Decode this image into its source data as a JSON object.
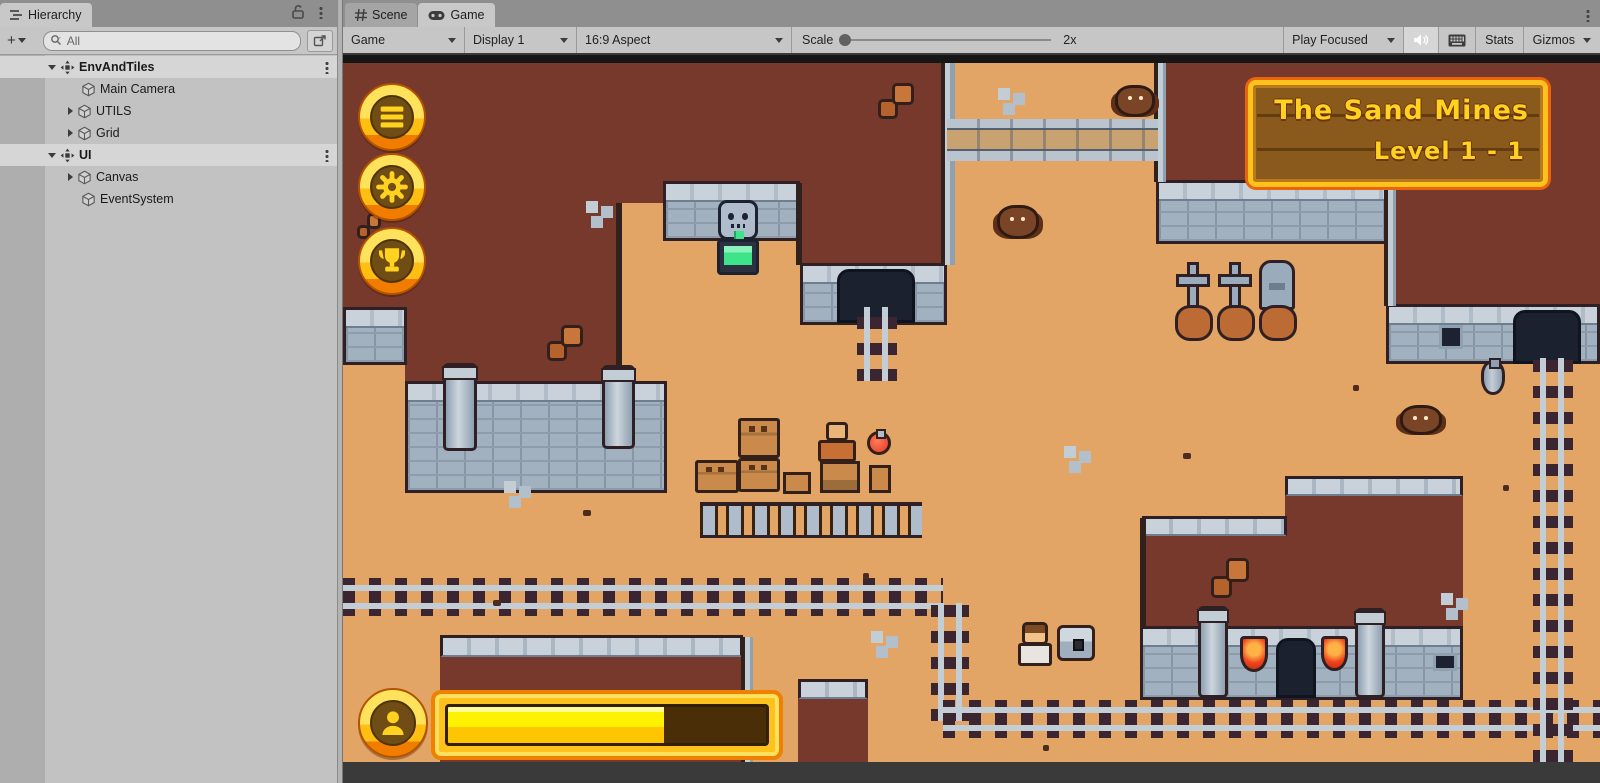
{
  "hierarchy": {
    "tab_label": "Hierarchy",
    "add_label": "+",
    "search_placeholder": "All",
    "rows": [
      {
        "label": "EnvAndTiles",
        "icon": "group",
        "depth": 0,
        "caret": "down",
        "bold": true,
        "selected": true,
        "kebab": true
      },
      {
        "label": "Main Camera",
        "icon": "cube",
        "depth": 1,
        "caret": "none"
      },
      {
        "label": "UTILS",
        "icon": "cube",
        "depth": 1,
        "caret": "right"
      },
      {
        "label": "Grid",
        "icon": "cube",
        "depth": 1,
        "caret": "right"
      },
      {
        "label": "UI",
        "icon": "group",
        "depth": 0,
        "caret": "down",
        "bold": true,
        "selected": true,
        "kebab": true
      },
      {
        "label": "Canvas",
        "icon": "cube",
        "depth": 1,
        "caret": "right"
      },
      {
        "label": "EventSystem",
        "icon": "cube",
        "depth": 1,
        "caret": "none"
      }
    ]
  },
  "gameview": {
    "tabs": [
      {
        "label": "Scene",
        "icon": "scene",
        "active": false
      },
      {
        "label": "Game",
        "icon": "game",
        "active": true
      }
    ],
    "toolbar": {
      "display_mode": "Game",
      "display": "Display 1",
      "aspect": "16:9 Aspect",
      "scale_label": "Scale",
      "scale_value": "2x",
      "play_mode": "Play Focused",
      "stats_label": "Stats",
      "gizmos_label": "Gizmos"
    }
  },
  "game": {
    "banner": {
      "line1": "The Sand Mines",
      "line2": "Level 1 - 1"
    },
    "hud": {
      "progress_percent": 68,
      "buttons": [
        {
          "icon": "menu",
          "name": "hud-menu-button"
        },
        {
          "icon": "gear",
          "name": "hud-settings-button"
        },
        {
          "icon": "trophy",
          "name": "hud-trophy-button"
        }
      ],
      "profile_icon": "person"
    },
    "palette": {
      "sand": "#e2a566",
      "earth": "#76392b",
      "stone": "#a2b1bf",
      "gold": "#ffc21c",
      "orange": "#f08000",
      "rail_tie": "#3b2531",
      "rail": "#c3cdd6",
      "water_green": "#3ee48a",
      "banner_wood": "#8a5a1d"
    },
    "terrain": [
      {
        "type": "brown",
        "name": "plateau-top-left-a",
        "x": 0,
        "y": 0,
        "w": 324,
        "h": 148
      },
      {
        "type": "brown",
        "name": "plateau-top-left-b",
        "x": 62,
        "y": 148,
        "w": 215,
        "h": 180
      },
      {
        "type": "brown",
        "name": "plateau-top-left-c",
        "x": 0,
        "y": 148,
        "w": 62,
        "h": 106
      },
      {
        "type": "wall",
        "name": "wall-top-left",
        "x": 0,
        "y": 252,
        "w": 64,
        "h": 58
      },
      {
        "type": "wall",
        "name": "wall-left-pillared",
        "x": 62,
        "y": 326,
        "w": 262,
        "h": 112
      },
      {
        "type": "brown",
        "name": "plateau-top-center",
        "x": 324,
        "y": 0,
        "w": 280,
        "h": 128
      },
      {
        "type": "wall",
        "name": "wall-fountain",
        "x": 320,
        "y": 126,
        "w": 140,
        "h": 60
      },
      {
        "type": "brown",
        "name": "plateau-center-right",
        "x": 457,
        "y": 126,
        "w": 147,
        "h": 84
      },
      {
        "type": "wall",
        "name": "wall-center-mine",
        "x": 457,
        "y": 208,
        "w": 147,
        "h": 62
      },
      {
        "type": "arch",
        "name": "mine-entrance-center",
        "x": 494,
        "y": 214,
        "w": 78,
        "h": 54
      },
      {
        "type": "brown",
        "name": "plateau-top-right",
        "x": 813,
        "y": 0,
        "w": 444,
        "h": 127
      },
      {
        "type": "wall",
        "name": "wall-top-right",
        "x": 813,
        "y": 125,
        "w": 234,
        "h": 64
      },
      {
        "type": "brown",
        "name": "plateau-right-step",
        "x": 1043,
        "y": 125,
        "w": 214,
        "h": 126
      },
      {
        "type": "wall",
        "name": "wall-right-mine",
        "x": 1043,
        "y": 249,
        "w": 214,
        "h": 60
      },
      {
        "type": "arch",
        "name": "mine-entrance-right",
        "x": 1170,
        "y": 255,
        "w": 68,
        "h": 54
      },
      {
        "type": "beam",
        "name": "edge-top-center-right",
        "x": 598,
        "y": 0,
        "w": 14,
        "h": 210
      },
      {
        "type": "beam",
        "name": "edge-top-right-left",
        "x": 811,
        "y": 0,
        "w": 12,
        "h": 127
      },
      {
        "type": "beam",
        "name": "edge-right-step",
        "x": 1041,
        "y": 127,
        "w": 12,
        "h": 124
      },
      {
        "type": "edge",
        "name": "edge-pocket-left",
        "x": 273,
        "y": 148,
        "w": 6,
        "h": 180
      },
      {
        "type": "edge",
        "name": "edge-pocket-right",
        "x": 453,
        "y": 128,
        "w": 6,
        "h": 82
      },
      {
        "type": "brown",
        "name": "temple-upper",
        "x": 942,
        "y": 423,
        "w": 178,
        "h": 46
      },
      {
        "type": "cap",
        "name": "temple-upper-cap",
        "x": 942,
        "y": 421,
        "w": 178,
        "h": 20
      },
      {
        "type": "brown",
        "name": "temple-body",
        "x": 799,
        "y": 463,
        "w": 321,
        "h": 112
      },
      {
        "type": "cap",
        "name": "temple-body-cap",
        "x": 799,
        "y": 461,
        "w": 145,
        "h": 20
      },
      {
        "type": "edge",
        "name": "temple-left-edge",
        "x": 797,
        "y": 463,
        "w": 6,
        "h": 110
      },
      {
        "type": "wall",
        "name": "temple-front-wall",
        "x": 797,
        "y": 571,
        "w": 323,
        "h": 74
      },
      {
        "type": "brown",
        "name": "plateau-bottom-left",
        "x": 97,
        "y": 582,
        "w": 303,
        "h": 125
      },
      {
        "type": "cap",
        "name": "plateau-bottom-left-cap",
        "x": 97,
        "y": 580,
        "w": 303,
        "h": 22
      },
      {
        "type": "beam",
        "name": "plateau-bottom-left-beam",
        "x": 398,
        "y": 582,
        "w": 12,
        "h": 125
      },
      {
        "type": "brown",
        "name": "plateau-bottom-small",
        "x": 455,
        "y": 626,
        "w": 70,
        "h": 81
      },
      {
        "type": "cap",
        "name": "plateau-bottom-small-cap",
        "x": 455,
        "y": 624,
        "w": 70,
        "h": 20
      },
      {
        "type": "bridge",
        "name": "rail-bridge-top",
        "x": 604,
        "y": 64,
        "w": 211,
        "h": 42
      },
      {
        "type": "railh",
        "name": "rail-mid",
        "x": 0,
        "y": 523,
        "w": 600,
        "h": 38
      },
      {
        "type": "railv",
        "name": "rail-curve-down",
        "x": 588,
        "y": 548,
        "w": 38,
        "h": 118
      },
      {
        "type": "railh",
        "name": "rail-bottom",
        "x": 600,
        "y": 645,
        "w": 657,
        "h": 38
      },
      {
        "type": "railv",
        "name": "rail-right",
        "x": 1190,
        "y": 303,
        "w": 40,
        "h": 404
      },
      {
        "type": "railv",
        "name": "rail-center-short",
        "x": 514,
        "y": 252,
        "w": 40,
        "h": 74
      },
      {
        "type": "bar",
        "name": "letterbox-top",
        "x": 0,
        "y": 0,
        "w": 1257,
        "h": 8
      }
    ],
    "sprites": [
      {
        "type": "skull",
        "name": "fountain-skull",
        "x": 375,
        "y": 145,
        "w": 40,
        "h": 40
      },
      {
        "type": "stream",
        "name": "fountain-stream",
        "x": 391,
        "y": 176,
        "w": 10,
        "h": 14
      },
      {
        "type": "basin",
        "name": "fountain-basin",
        "x": 374,
        "y": 184,
        "w": 42,
        "h": 36
      },
      {
        "type": "pillar",
        "name": "wall-pillar-a",
        "x": 100,
        "y": 308,
        "w": 34,
        "h": 88
      },
      {
        "type": "pillar",
        "name": "wall-pillar-b",
        "x": 259,
        "y": 310,
        "w": 33,
        "h": 84
      },
      {
        "type": "pillar",
        "name": "temple-pillar-a",
        "x": 855,
        "y": 551,
        "w": 30,
        "h": 92
      },
      {
        "type": "pillar",
        "name": "temple-pillar-b",
        "x": 1012,
        "y": 553,
        "w": 30,
        "h": 90
      },
      {
        "type": "flag",
        "name": "temple-banner-a",
        "x": 897,
        "y": 581,
        "w": 28,
        "h": 36
      },
      {
        "type": "flag",
        "name": "temple-banner-b",
        "x": 978,
        "y": 581,
        "w": 27,
        "h": 35
      },
      {
        "type": "arch",
        "name": "temple-doorway",
        "x": 933,
        "y": 583,
        "w": 40,
        "h": 60
      },
      {
        "type": "window",
        "name": "temple-vent",
        "x": 1090,
        "y": 598,
        "w": 24,
        "h": 18
      },
      {
        "type": "window",
        "name": "wall-window",
        "x": 1096,
        "y": 270,
        "w": 24,
        "h": 24
      },
      {
        "type": "cross",
        "name": "grave-cross-a",
        "x": 833,
        "y": 207,
        "w": 34,
        "h": 48
      },
      {
        "type": "cross",
        "name": "grave-cross-b",
        "x": 875,
        "y": 207,
        "w": 34,
        "h": 48
      },
      {
        "type": "tomb",
        "name": "grave-stone",
        "x": 916,
        "y": 205,
        "w": 36,
        "h": 50
      },
      {
        "type": "mound",
        "name": "grave-mound-a",
        "x": 832,
        "y": 250,
        "w": 38,
        "h": 36
      },
      {
        "type": "mound",
        "name": "grave-mound-b",
        "x": 874,
        "y": 250,
        "w": 38,
        "h": 36
      },
      {
        "type": "mound",
        "name": "grave-mound-c",
        "x": 916,
        "y": 250,
        "w": 38,
        "h": 36
      },
      {
        "type": "crate",
        "name": "crate-tall-top",
        "x": 395,
        "y": 363,
        "w": 42,
        "h": 40
      },
      {
        "type": "crate",
        "name": "crate-tall-bottom",
        "x": 395,
        "y": 403,
        "w": 42,
        "h": 34
      },
      {
        "type": "crate",
        "name": "crate-left",
        "x": 352,
        "y": 405,
        "w": 44,
        "h": 33
      },
      {
        "type": "stand",
        "name": "crate-small",
        "x": 440,
        "y": 417,
        "w": 28,
        "h": 22
      },
      {
        "type": "vendor",
        "name": "shop-vendor",
        "x": 475,
        "y": 367,
        "w": 38,
        "h": 40
      },
      {
        "type": "counter",
        "name": "shop-counter",
        "x": 477,
        "y": 406,
        "w": 40,
        "h": 32
      },
      {
        "type": "potion",
        "name": "shop-potion",
        "x": 524,
        "y": 376,
        "w": 24,
        "h": 24
      },
      {
        "type": "stand",
        "name": "shop-potion-stand",
        "x": 526,
        "y": 410,
        "w": 22,
        "h": 28
      },
      {
        "type": "fence",
        "name": "shop-fence",
        "x": 357,
        "y": 447,
        "w": 222,
        "h": 36
      },
      {
        "type": "player",
        "name": "player-character",
        "x": 675,
        "y": 567,
        "w": 34,
        "h": 44
      },
      {
        "type": "chest",
        "name": "treasure-chest",
        "x": 714,
        "y": 570,
        "w": 38,
        "h": 36
      },
      {
        "type": "bat",
        "name": "bat-a",
        "x": 772,
        "y": 30,
        "w": 40,
        "h": 32
      },
      {
        "type": "bat",
        "name": "bat-b",
        "x": 654,
        "y": 150,
        "w": 42,
        "h": 34
      },
      {
        "type": "bat",
        "name": "bat-c",
        "x": 1057,
        "y": 350,
        "w": 42,
        "h": 30
      },
      {
        "type": "ore",
        "name": "ore-rocks-a",
        "x": 535,
        "y": 28,
        "w": 36,
        "h": 36
      },
      {
        "type": "ore",
        "name": "ore-rocks-b",
        "x": 868,
        "y": 503,
        "w": 38,
        "h": 40
      },
      {
        "type": "ore",
        "name": "ore-rocks-c",
        "x": 204,
        "y": 270,
        "w": 36,
        "h": 36
      },
      {
        "type": "ore",
        "name": "ore-rocks-d",
        "x": 14,
        "y": 158,
        "w": 24,
        "h": 26
      },
      {
        "type": "pebbles",
        "name": "pebbles-a",
        "x": 243,
        "y": 146,
        "w": 38,
        "h": 32
      },
      {
        "type": "pebbles",
        "name": "pebbles-b",
        "x": 655,
        "y": 33,
        "w": 32,
        "h": 28
      },
      {
        "type": "pebbles",
        "name": "pebbles-c",
        "x": 161,
        "y": 426,
        "w": 40,
        "h": 26
      },
      {
        "type": "pebbles",
        "name": "pebbles-d",
        "x": 721,
        "y": 391,
        "w": 32,
        "h": 28
      },
      {
        "type": "pebbles",
        "name": "pebbles-e",
        "x": 1098,
        "y": 538,
        "w": 28,
        "h": 28
      },
      {
        "type": "pebbles",
        "name": "pebbles-f",
        "x": 528,
        "y": 576,
        "w": 26,
        "h": 22
      },
      {
        "type": "vase",
        "name": "clay-jug",
        "x": 1138,
        "y": 306,
        "w": 24,
        "h": 34
      },
      {
        "type": "speck",
        "name": "sand-speck-a",
        "x": 240,
        "y": 455,
        "w": 8,
        "h": 6
      },
      {
        "type": "speck",
        "name": "sand-speck-b",
        "x": 520,
        "y": 518,
        "w": 6,
        "h": 6
      },
      {
        "type": "speck",
        "name": "sand-speck-c",
        "x": 840,
        "y": 398,
        "w": 8,
        "h": 6
      },
      {
        "type": "speck",
        "name": "sand-speck-d",
        "x": 1010,
        "y": 330,
        "w": 6,
        "h": 6
      },
      {
        "type": "speck",
        "name": "sand-speck-e",
        "x": 150,
        "y": 545,
        "w": 8,
        "h": 6
      },
      {
        "type": "speck",
        "name": "sand-speck-f",
        "x": 700,
        "y": 690,
        "w": 6,
        "h": 6
      },
      {
        "type": "speck",
        "name": "sand-speck-g",
        "x": 980,
        "y": 118,
        "w": 6,
        "h": 6
      },
      {
        "type": "speck",
        "name": "sand-speck-h",
        "x": 1160,
        "y": 430,
        "w": 6,
        "h": 6
      }
    ]
  }
}
